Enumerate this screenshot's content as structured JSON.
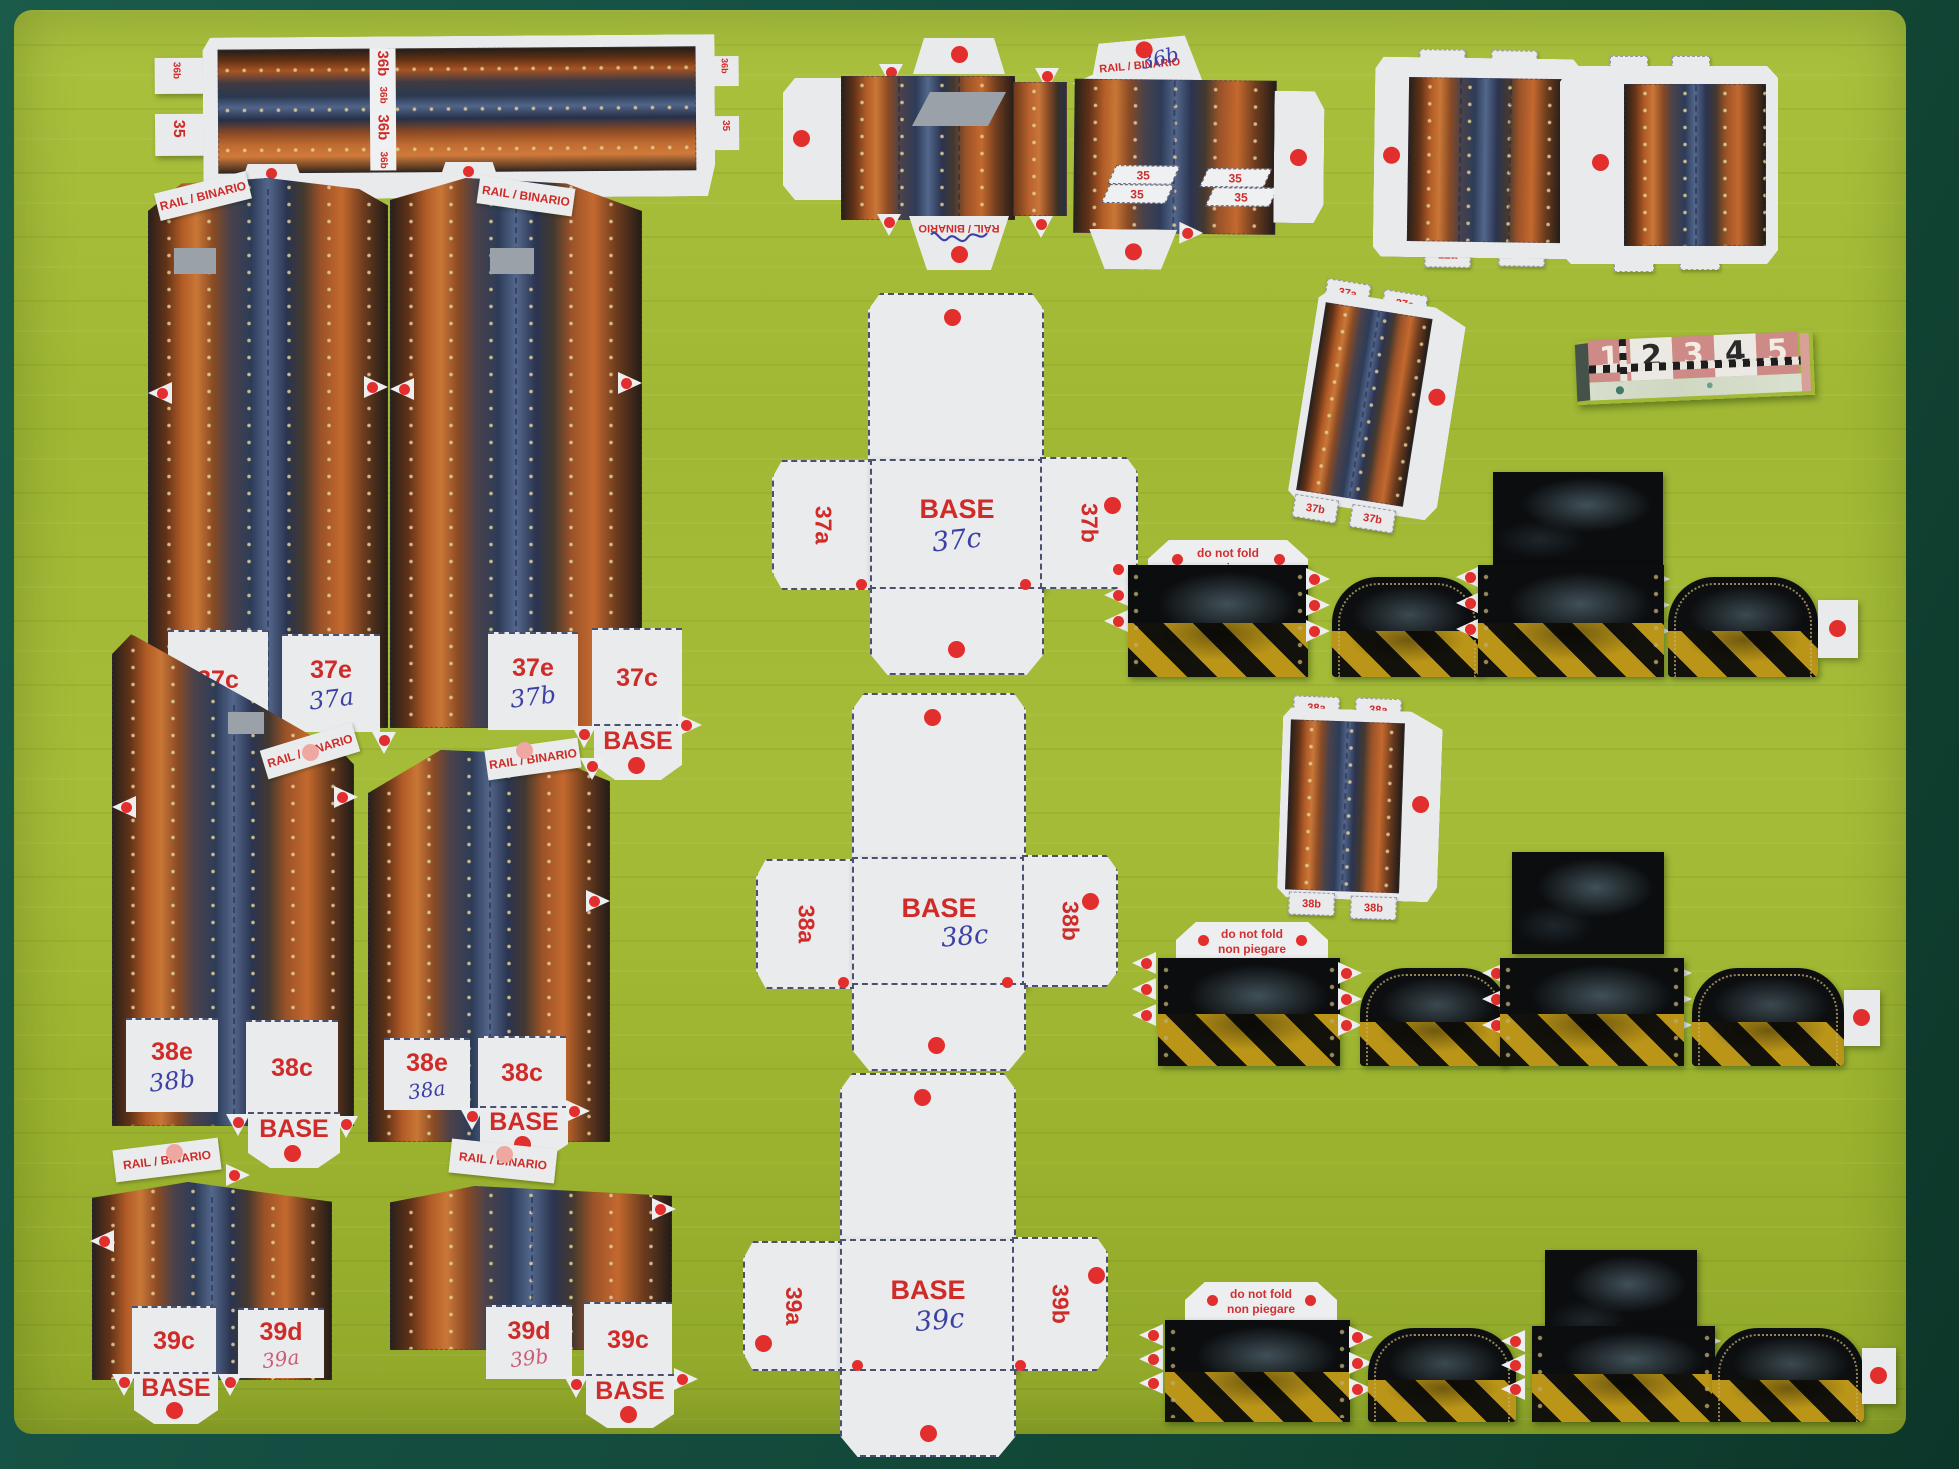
{
  "scene": {
    "mat_color": "#a3bb36",
    "surround_color": "#124635",
    "red_dot": "#e22f2d",
    "label_red": "#cf2b28"
  },
  "common": {
    "rail": "RAIL / BINARIO",
    "base": "BASE",
    "fold1": "do not fold",
    "fold2": "non piegare"
  },
  "strip36": {
    "tab_left_top": "36b",
    "tab_left_bottom": "35",
    "divider": [
      "36b",
      "36b",
      "36b",
      "36b"
    ],
    "tab_right_top": "36b",
    "tab_right_bottom": "35"
  },
  "wall35": {
    "handwritten": "36b",
    "tabs": [
      "35",
      "35",
      "35",
      "35"
    ]
  },
  "plate10": {
    "top": [
      "10a",
      "10a"
    ],
    "bottom": [
      "11a",
      "11a"
    ]
  },
  "plate8": {
    "top": [
      "8",
      "8"
    ],
    "bottom": [
      "9",
      "9"
    ]
  },
  "gauge": {
    "numbers": [
      "1",
      "2",
      "3",
      "4",
      "5"
    ]
  },
  "tabs37": {
    "top": [
      "37a",
      "37a"
    ],
    "bottom": [
      "37b",
      "37b"
    ]
  },
  "tabs38": {
    "top": [
      "38a",
      "38a"
    ],
    "bottom": [
      "38b",
      "38b"
    ]
  },
  "wall37L": {
    "p1": "37c",
    "p2": "37e",
    "hand": "37a"
  },
  "wall37R": {
    "p1": "37e",
    "hand": "37b",
    "p2": "37c"
  },
  "wall38L": {
    "p1": "38e",
    "hand": "38b",
    "p2": "38c"
  },
  "wall38R": {
    "p1": "38e",
    "hand": "38a",
    "p2": "38c"
  },
  "wall39L": {
    "p1": "39c",
    "p2": "39d",
    "hand": "39a"
  },
  "wall39R": {
    "p1": "39d",
    "hand": "39b",
    "p2": "39c"
  },
  "cross37": {
    "left": "37a",
    "hand": "37c",
    "right": "37b"
  },
  "cross38": {
    "left": "38a",
    "hand": "38c",
    "right": "38b"
  },
  "cross39": {
    "left": "39a",
    "hand": "39c",
    "right": "39b"
  }
}
